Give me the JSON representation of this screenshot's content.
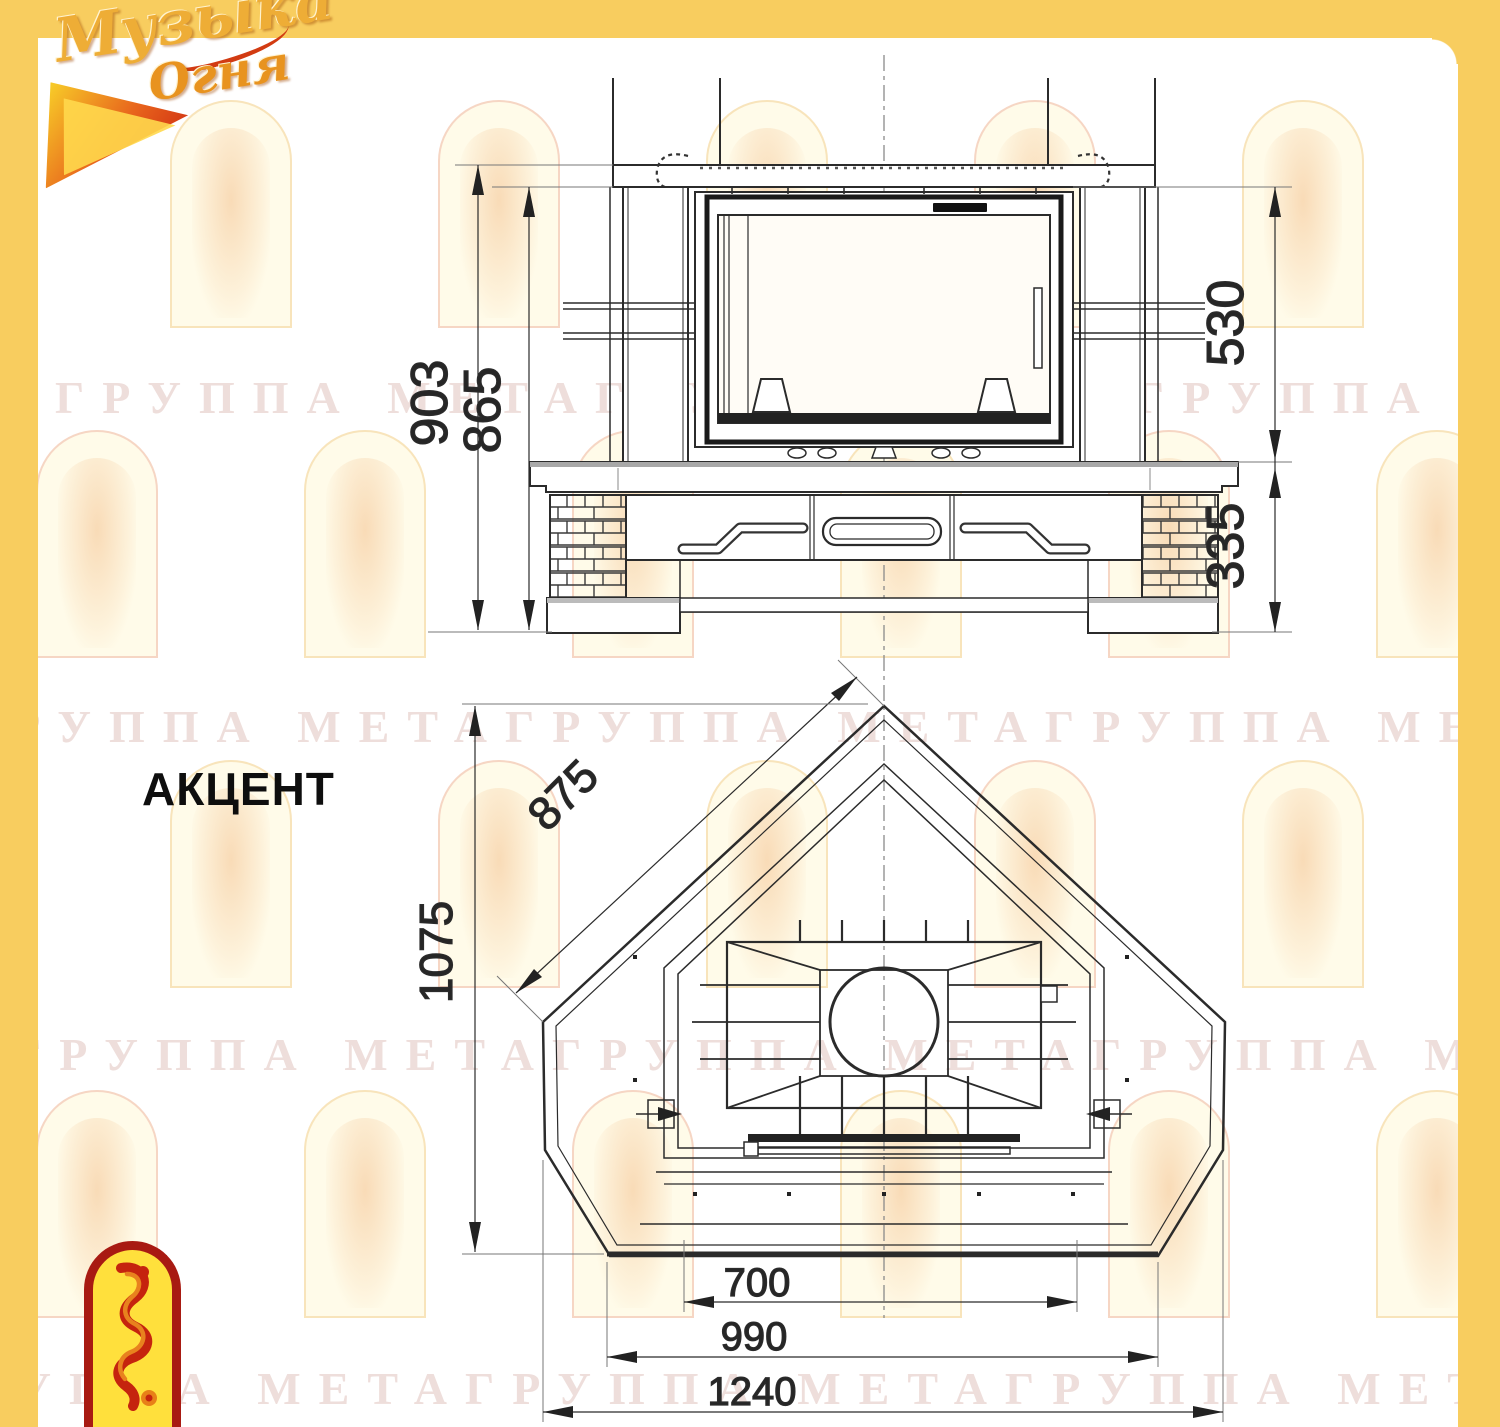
{
  "logo_top": {
    "word1": "Музыка",
    "word2": "Огня"
  },
  "model_title": "АКЦЕНТ",
  "watermark_text": "ГРУППА МЕТАГРУППА МЕТАГРУППА МЕТА",
  "front_view": {
    "dim_labels": {
      "overall_height": "903",
      "height_to_shelf": "865",
      "firebox_height": "530",
      "base_height": "335"
    }
  },
  "plan_view": {
    "dim_labels": {
      "side_edge": "875",
      "depth": "1075",
      "firebox_width": "700",
      "front_width": "990",
      "overall_width": "1240"
    }
  },
  "colors": {
    "frame_yellow": "#F8CD5F",
    "logo_red": "#A81A12",
    "logo_gold": "#EEAD36",
    "drawing_ink": "#2B2B2B",
    "watermark_pink": "#CB9B93"
  }
}
